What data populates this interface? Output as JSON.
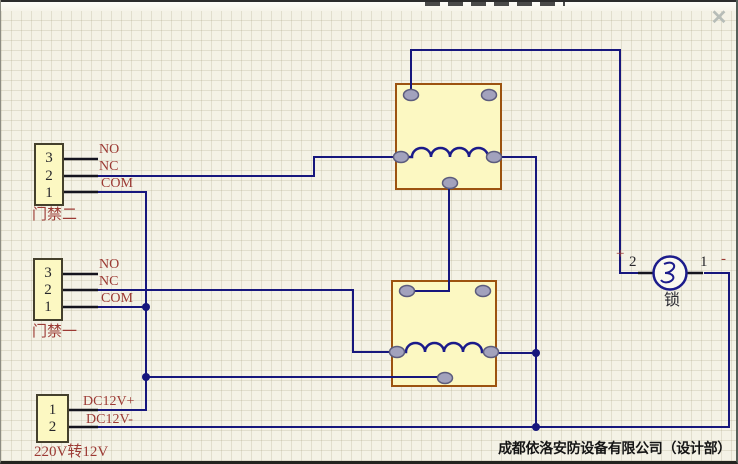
{
  "window": {
    "close_glyph": "✕",
    "credit": "成都依洛安防设备有限公司（设计部）"
  },
  "connectors": {
    "access2": {
      "name": "门禁二",
      "pins": [
        "3",
        "2",
        "1"
      ],
      "signals": [
        "NO",
        "NC",
        "COM"
      ]
    },
    "access1": {
      "name": "门禁一",
      "pins": [
        "3",
        "2",
        "1"
      ],
      "signals": [
        "NO",
        "NC",
        "COM"
      ]
    },
    "power": {
      "name": "220V转12V",
      "pins": [
        "1",
        "2"
      ],
      "signals": [
        "DC12V+",
        "DC12V-"
      ]
    }
  },
  "lock": {
    "name": "锁",
    "left_polarity": "+",
    "left_pin": "2",
    "right_pin": "1",
    "right_polarity": "-"
  },
  "colors": {
    "canvas_bg": "#f4f2e6",
    "grid_line": "#e2dfcd",
    "wire": "#16167d",
    "pin_stub": "#14141e",
    "component_fill": "#fcf8c2",
    "relay_border": "#9c5310",
    "connector_border": "#44402c",
    "label_red": "#9c3a34",
    "pad_fill": "#a2a2bd",
    "pad_border": "#5c5c7d",
    "junction": "#16167d",
    "credit_text": "#151515",
    "close_icon": "#b7bdb8"
  }
}
